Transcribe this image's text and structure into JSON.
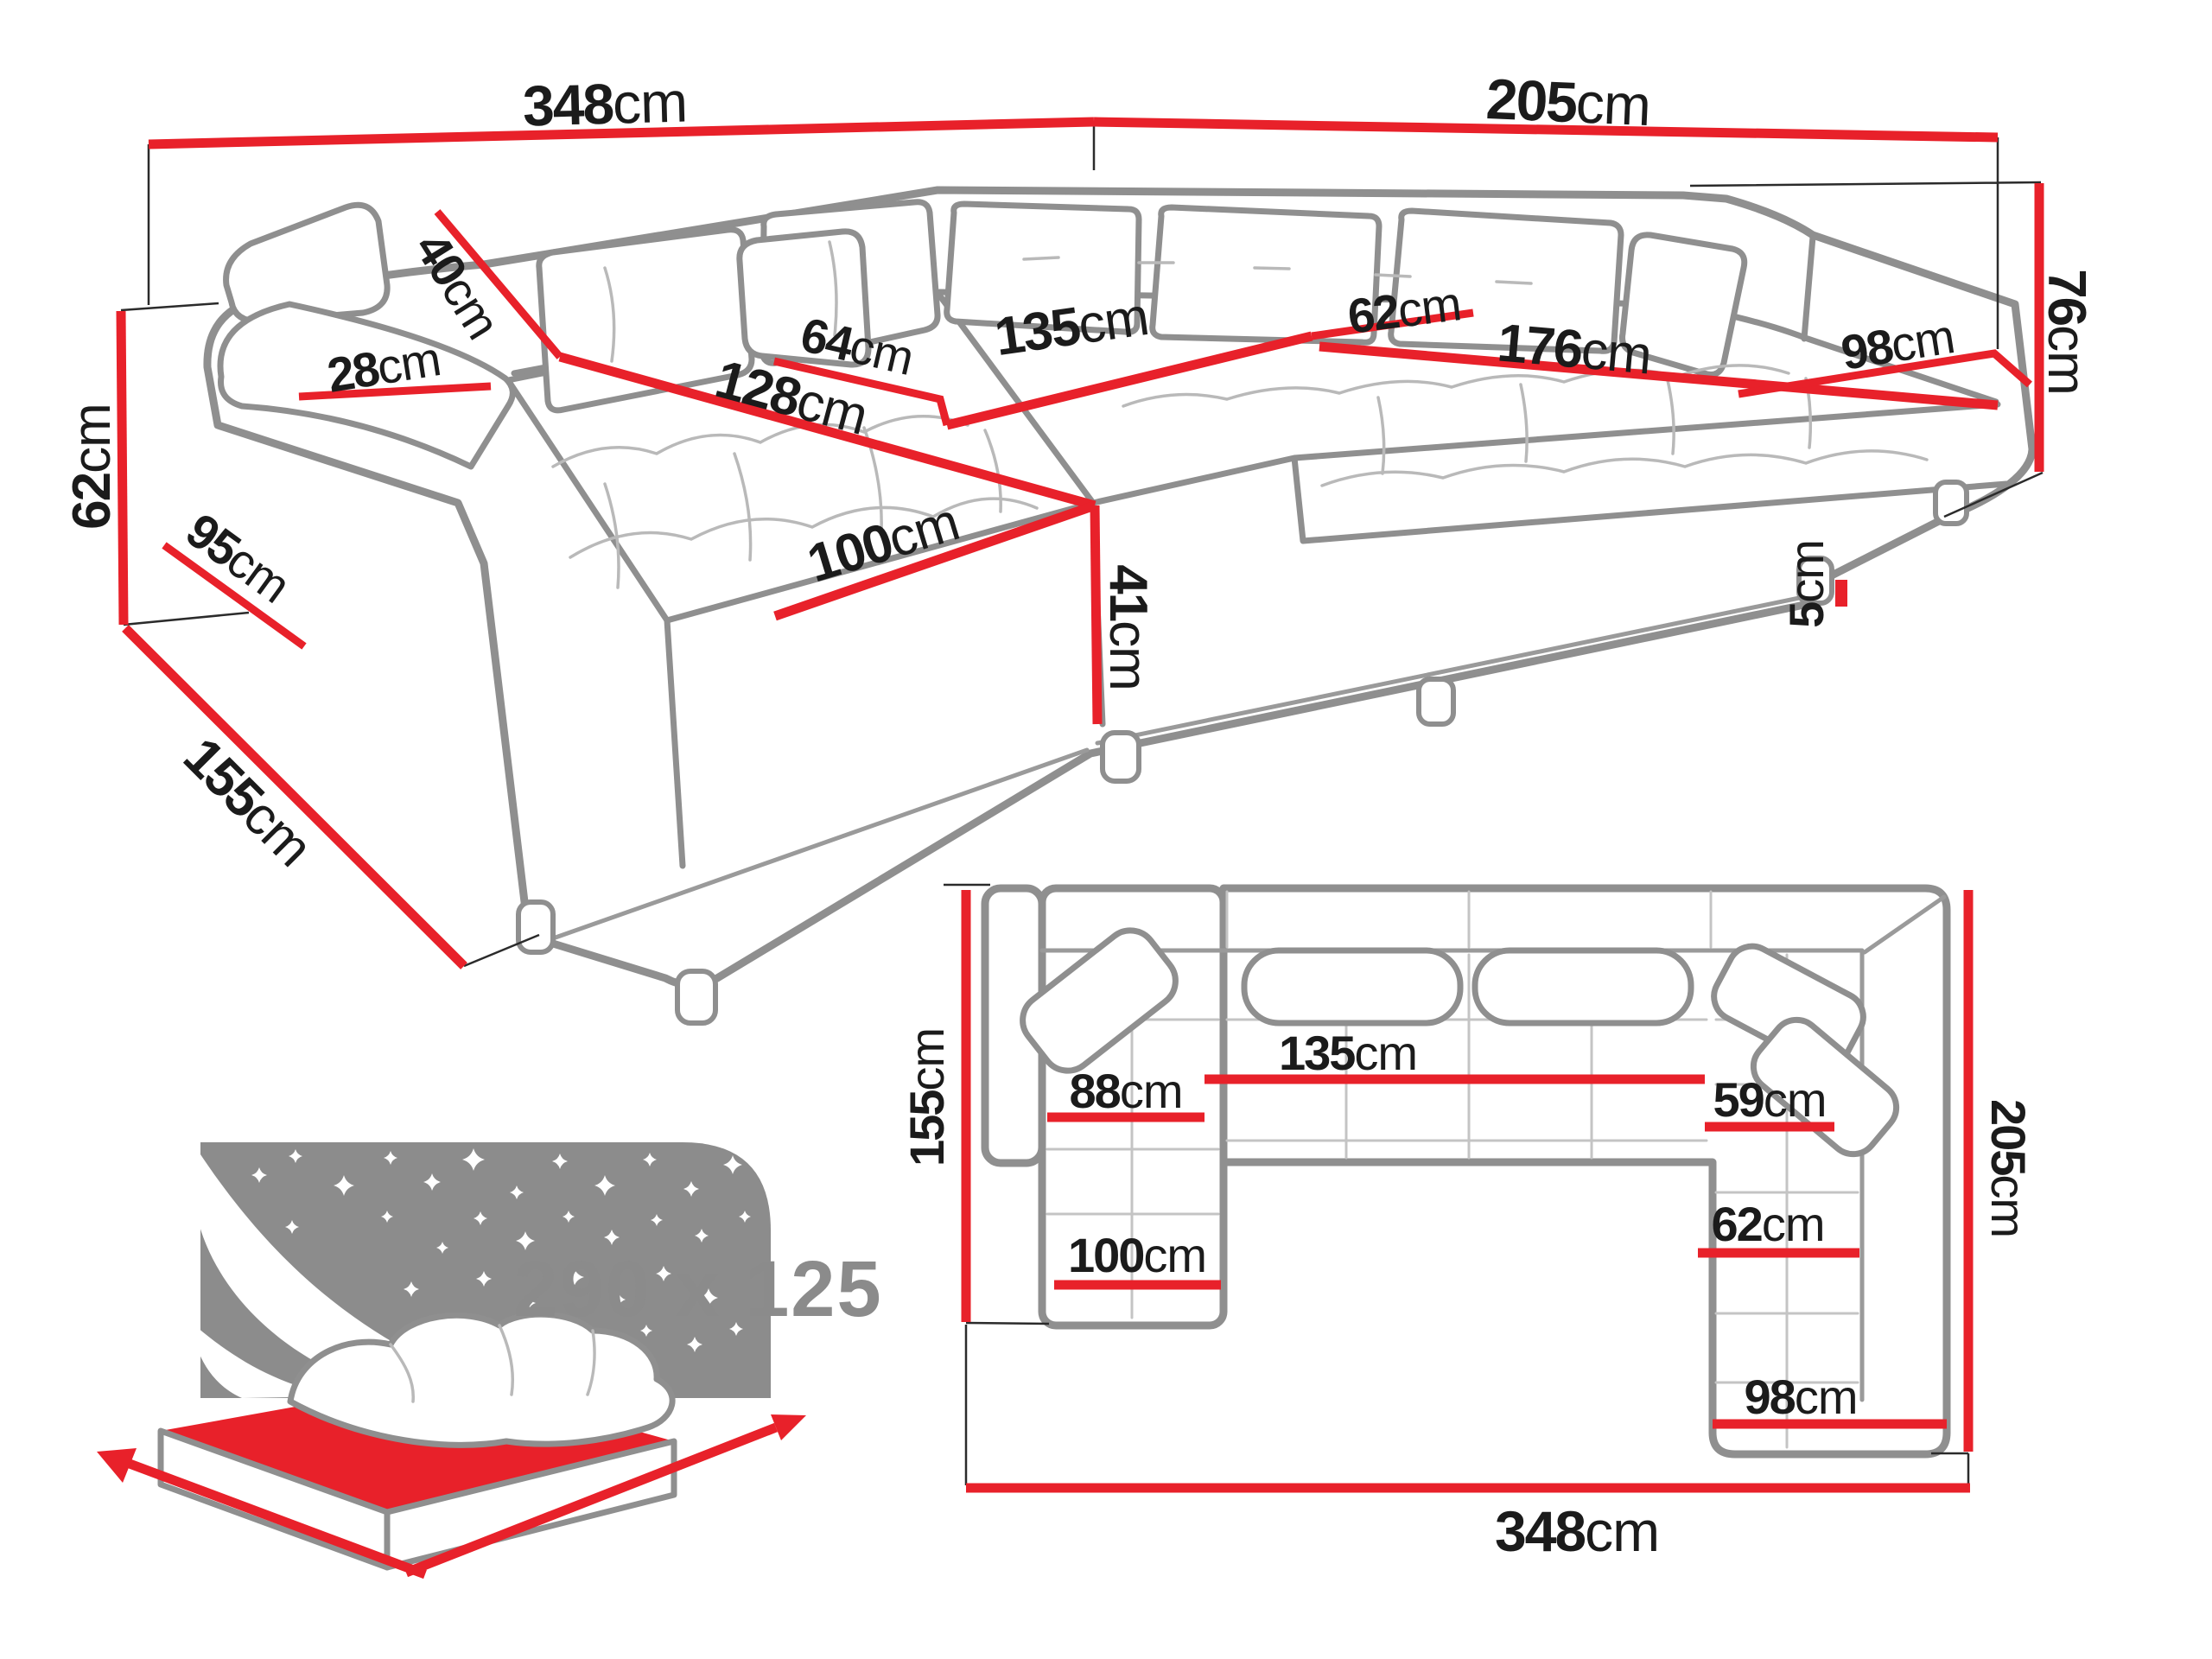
{
  "title": "U-shaped corner sofa dimensions diagram",
  "colors": {
    "dimension_line_red": "#e8212a",
    "outline_gray": "#8f8f8f",
    "label_black": "#1b1b1b",
    "icon_gray": "#8c8c8c",
    "background": "#ffffff"
  },
  "view_3d": {
    "back_width_left": {
      "num": "348",
      "unit": "cm"
    },
    "back_width_right": {
      "num": "205",
      "unit": "cm"
    },
    "backrest_height_total": {
      "num": "76",
      "unit": "cm"
    },
    "armrest_height": {
      "num": "62",
      "unit": "cm"
    },
    "armrest_top_width": {
      "num": "28",
      "unit": "cm"
    },
    "armrest_side_depth": {
      "num": "95",
      "unit": "cm"
    },
    "chaise_footprint_depth": {
      "num": "155",
      "unit": "cm"
    },
    "back_cushion_height": {
      "num": "40",
      "unit": "cm"
    },
    "chaise_length": {
      "num": "128",
      "unit": "cm"
    },
    "mid_seat_depth": {
      "num": "64",
      "unit": "cm"
    },
    "mid_seat_width": {
      "num": "135",
      "unit": "cm"
    },
    "right_seat_depth": {
      "num": "62",
      "unit": "cm"
    },
    "right_seat_width": {
      "num": "176",
      "unit": "cm"
    },
    "corner_seat_width": {
      "num": "98",
      "unit": "cm"
    },
    "chaise_width": {
      "num": "100",
      "unit": "cm"
    },
    "seat_height": {
      "num": "41",
      "unit": "cm"
    },
    "leg_height": {
      "num": "5",
      "unit": "cm"
    }
  },
  "view_plan": {
    "depth_left": {
      "num": "155",
      "unit": "cm"
    },
    "chaise_inner_length": {
      "num": "88",
      "unit": "cm"
    },
    "mid_seat_width": {
      "num": "135",
      "unit": "cm"
    },
    "right_seat_depth_upper": {
      "num": "59",
      "unit": "cm"
    },
    "depth_right": {
      "num": "205",
      "unit": "cm"
    },
    "right_seat_depth_lower": {
      "num": "62",
      "unit": "cm"
    },
    "chaise_width": {
      "num": "100",
      "unit": "cm"
    },
    "corner_seat_width": {
      "num": "98",
      "unit": "cm"
    },
    "total_width": {
      "num": "348",
      "unit": "cm"
    }
  },
  "sleeping_area": {
    "size": "290 x 125"
  }
}
